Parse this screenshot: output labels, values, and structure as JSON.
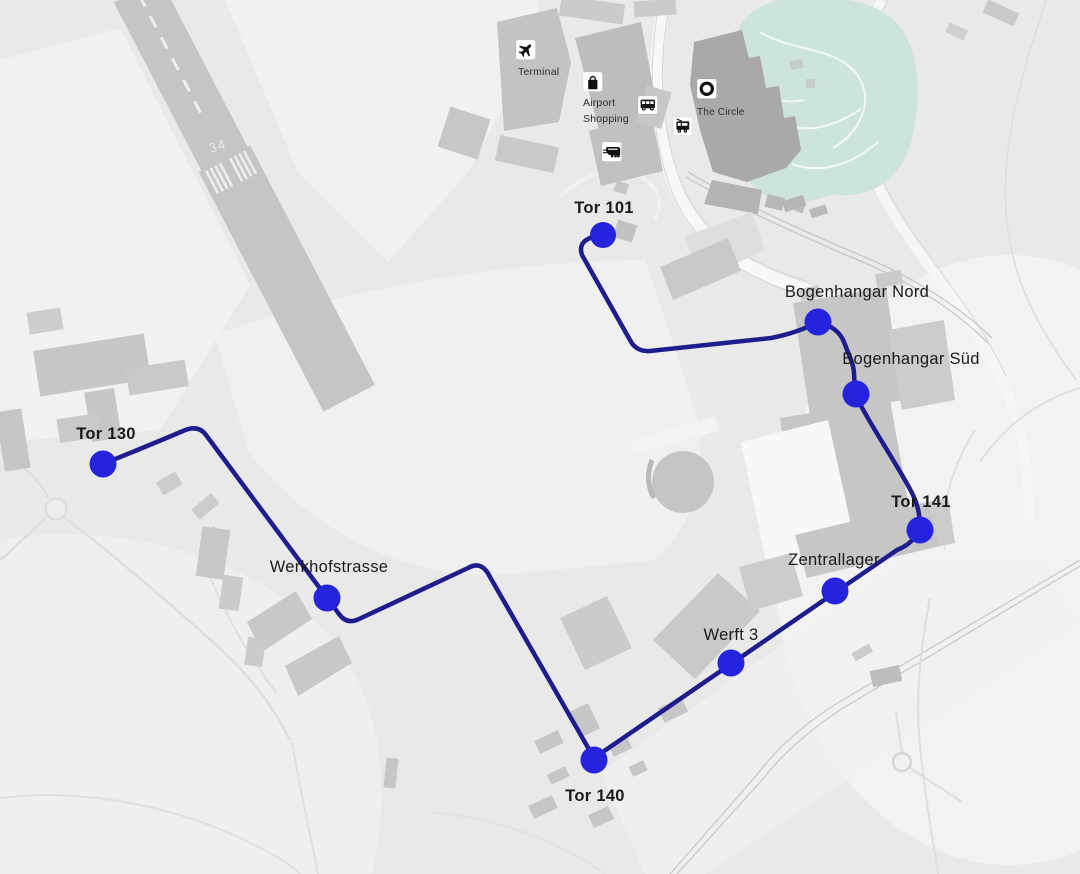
{
  "stops": [
    {
      "id": "tor-130",
      "label": "Tor 130",
      "emphasis": "bold"
    },
    {
      "id": "werkhofstrasse",
      "label": "Werkhofstrasse",
      "emphasis": "regular"
    },
    {
      "id": "tor-140",
      "label": "Tor 140",
      "emphasis": "bold"
    },
    {
      "id": "werft-3",
      "label": "Werft 3",
      "emphasis": "regular"
    },
    {
      "id": "zentrallager",
      "label": "Zentrallager",
      "emphasis": "regular"
    },
    {
      "id": "tor-141",
      "label": "Tor 141",
      "emphasis": "bold"
    },
    {
      "id": "bogenhangar-sued",
      "label": "Bogenhangar Süd",
      "emphasis": "regular"
    },
    {
      "id": "bogenhangar-nord",
      "label": "Bogenhangar Nord",
      "emphasis": "regular"
    },
    {
      "id": "tor-101",
      "label": "Tor 101",
      "emphasis": "bold"
    }
  ],
  "pois": [
    {
      "id": "terminal",
      "label": "Terminal",
      "icon": "airplane-icon"
    },
    {
      "id": "airport-shopping",
      "label": "Airport Shopping",
      "lines": [
        "Airport",
        "Shopping"
      ],
      "icon": "shopping-bag-icon"
    },
    {
      "id": "the-circle",
      "label": "The Circle",
      "icon": "circle-icon"
    },
    {
      "id": "bus-stop",
      "icon": "bus-icon"
    },
    {
      "id": "tram-stop",
      "icon": "tram-icon"
    },
    {
      "id": "train-station",
      "icon": "train-icon"
    }
  ],
  "runway": {
    "number": "34"
  },
  "colors": {
    "background": "#e9e9e9",
    "route_line": "#1d1d8d",
    "stop_marker": "#2424dd",
    "park": "#cde3de",
    "building": "#c6c6c6",
    "building_dark": "#a9a9a9",
    "label_text": "#1a1a1a"
  }
}
